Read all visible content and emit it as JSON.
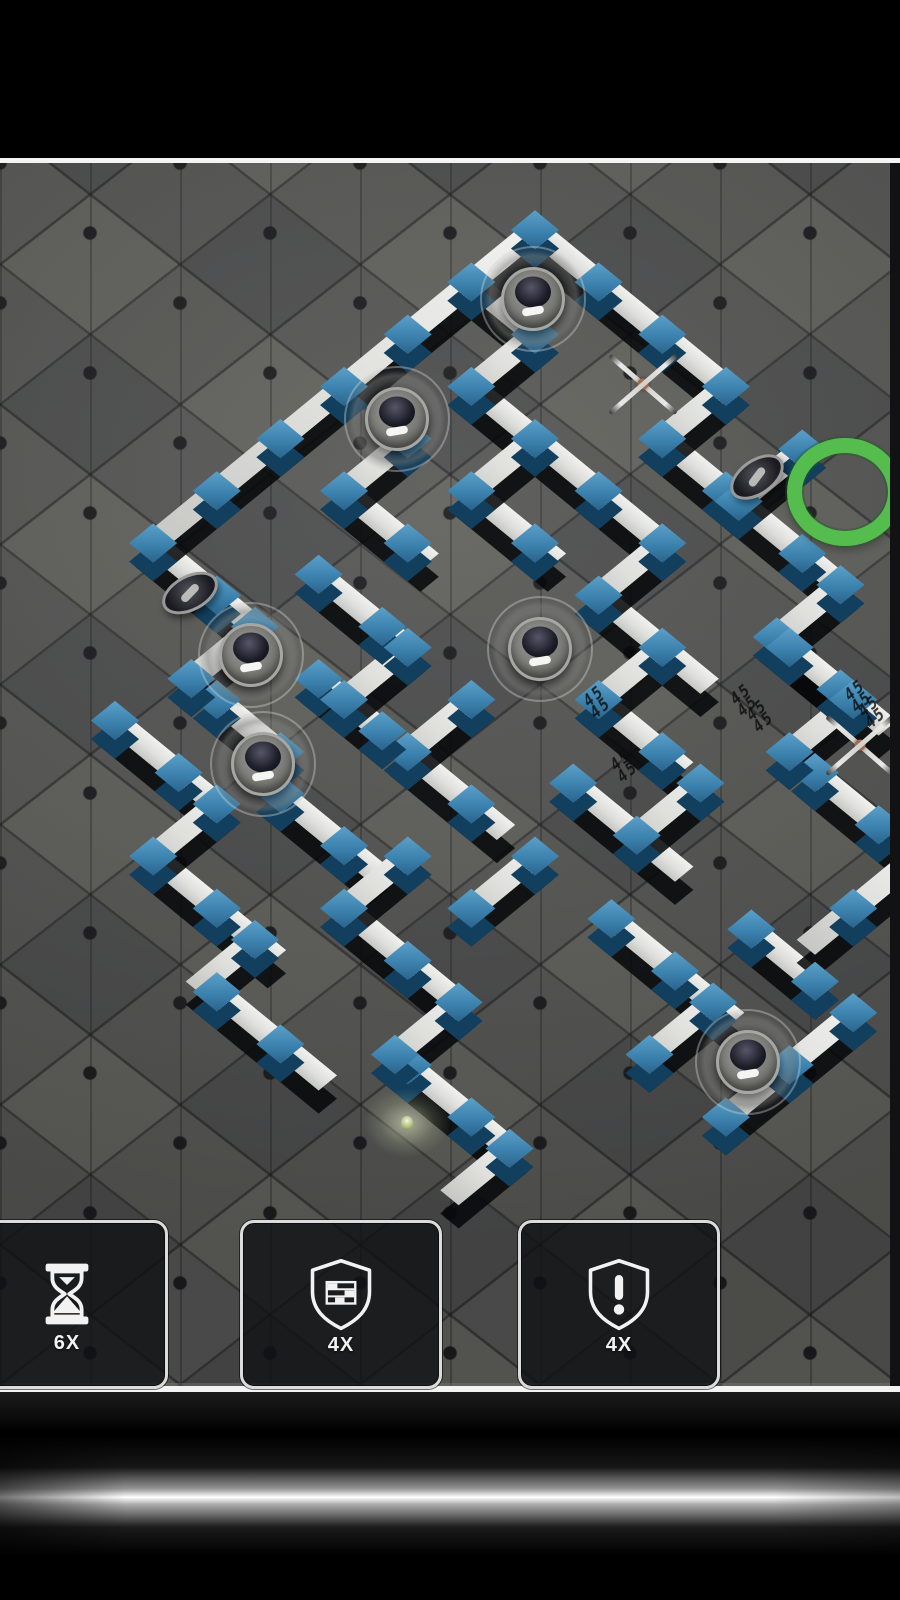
{
  "hud": {
    "boosters": [
      {
        "name": "time-booster",
        "icon": "hourglass-icon",
        "count": "6X"
      },
      {
        "name": "wall-booster",
        "icon": "shield-brick-icon",
        "count": "4X"
      },
      {
        "name": "alert-booster",
        "icon": "shield-alert-icon",
        "count": "4X"
      }
    ]
  },
  "colors": {
    "wall_top": "#e6e6e4",
    "wall_shadow": "#07080a",
    "connector_blue": "#3c82ae",
    "connector_blue_dark": "#123f5e",
    "floor": "#575754",
    "goal_green": "#55bd4e",
    "frame_white": "#f4f4f4",
    "button_border": "#dcdcdc"
  },
  "board": {
    "origin_x": 535,
    "origin_y": 230,
    "game_top": 163,
    "cell": 90,
    "rotation_deg": 45,
    "squash": 0.82,
    "segments": [
      {
        "d": "h",
        "x": 0,
        "y": 0,
        "l": 3
      },
      {
        "d": "h",
        "x": 3,
        "y": 1,
        "l": 1.2
      },
      {
        "d": "h",
        "x": 4.2,
        "y": 1,
        "l": 1.6
      },
      {
        "d": "h",
        "x": 5.8,
        "y": 2,
        "l": 1.2
      },
      {
        "d": "h",
        "x": 0,
        "y": 1,
        "l": 1,
        "t": 1
      },
      {
        "d": "h",
        "x": 1,
        "y": 2,
        "l": 2
      },
      {
        "d": "h",
        "x": 3,
        "y": 2,
        "l": 1
      },
      {
        "d": "h",
        "x": 2,
        "y": 3,
        "l": 1.2
      },
      {
        "d": "h",
        "x": 4,
        "y": 3,
        "l": 1.6
      },
      {
        "d": "h",
        "x": 6,
        "y": 2,
        "l": 1.4
      },
      {
        "d": "h",
        "x": 7.4,
        "y": 3,
        "l": 1.6
      },
      {
        "d": "h",
        "x": 5,
        "y": 4,
        "l": 1.2
      },
      {
        "d": "h",
        "x": 5.6,
        "y": 5,
        "l": 1.6
      },
      {
        "d": "h",
        "x": 8.4,
        "y": 5,
        "l": 1
      },
      {
        "d": "h",
        "x": 7.2,
        "y": 6,
        "l": 1.8
      },
      {
        "d": "h",
        "x": 4,
        "y": 6,
        "l": 1.4
      },
      {
        "d": "h",
        "x": 2.6,
        "y": 6,
        "l": 1,
        "t": 1
      },
      {
        "d": "h",
        "x": 0,
        "y": 6,
        "l": 1.6,
        "t": 1
      },
      {
        "d": "h",
        "x": 1.6,
        "y": 5,
        "l": 1.4
      },
      {
        "d": "h",
        "x": 1,
        "y": 4,
        "l": 1.2
      },
      {
        "d": "h",
        "x": 2,
        "y": 7,
        "l": 1,
        "t": 1
      },
      {
        "d": "h",
        "x": 3.4,
        "y": 7.4,
        "l": 1.4
      },
      {
        "d": "h",
        "x": 5,
        "y": 8,
        "l": 1.8
      },
      {
        "d": "h",
        "x": 7,
        "y": 9,
        "l": 1.6
      },
      {
        "d": "h",
        "x": 1.4,
        "y": 8,
        "l": 1.6,
        "t": 1
      },
      {
        "d": "h",
        "x": 3,
        "y": 9,
        "l": 1.8,
        "t": 1
      },
      {
        "d": "h",
        "x": 4.8,
        "y": 9.8,
        "l": 1.6,
        "t": 1
      },
      {
        "d": "v",
        "x": 3,
        "y": 0,
        "l": 1
      },
      {
        "d": "v",
        "x": 4.2,
        "y": 0,
        "l": 1
      },
      {
        "d": "v",
        "x": 5.8,
        "y": 1,
        "l": 1
      },
      {
        "d": "v",
        "x": 7,
        "y": 2,
        "l": 1
      },
      {
        "d": "v",
        "x": 9,
        "y": 3,
        "l": 1.6
      },
      {
        "d": "v",
        "x": 1,
        "y": 1,
        "l": 1
      },
      {
        "d": "v",
        "x": 0,
        "y": 0,
        "l": 6,
        "t": 1
      },
      {
        "d": "v",
        "x": 2,
        "y": 2,
        "l": 1
      },
      {
        "d": "v",
        "x": 4,
        "y": 2,
        "l": 1
      },
      {
        "d": "v",
        "x": 5,
        "y": 3,
        "l": 1
      },
      {
        "d": "v",
        "x": 6.6,
        "y": 4,
        "l": 1
      },
      {
        "d": "v",
        "x": 1,
        "y": 3,
        "l": 1
      },
      {
        "d": "v",
        "x": 3,
        "y": 5,
        "l": 1
      },
      {
        "d": "v",
        "x": 1.6,
        "y": 6,
        "l": 1,
        "t": 1
      },
      {
        "d": "v",
        "x": 5,
        "y": 7,
        "l": 1
      },
      {
        "d": "v",
        "x": 6.8,
        "y": 8,
        "l": 1
      },
      {
        "d": "v",
        "x": 8.6,
        "y": 9,
        "l": 0.8
      },
      {
        "d": "v",
        "x": 3,
        "y": 8,
        "l": 1,
        "t": 1
      },
      {
        "d": "v",
        "x": 4.6,
        "y": 9,
        "l": 0.8
      },
      {
        "d": "v",
        "x": 10,
        "y": 5,
        "l": 2
      },
      {
        "d": "v",
        "x": 8.8,
        "y": 6,
        "l": 1
      },
      {
        "d": "v",
        "x": 4,
        "y": 5,
        "l": 1
      },
      {
        "d": "v",
        "x": 6,
        "y": 6,
        "l": 1
      }
    ],
    "cameras": [
      [
        533,
        299
      ],
      [
        397,
        419
      ],
      [
        251,
        655
      ],
      [
        540,
        649
      ],
      [
        263,
        764
      ],
      [
        748,
        1062
      ]
    ],
    "small_cameras": [
      [
        757,
        477,
        -35
      ],
      [
        190,
        593,
        -28
      ]
    ],
    "drones": [
      [
        643,
        384
      ],
      [
        860,
        745
      ]
    ],
    "goal": {
      "x": 845,
      "y": 492
    },
    "player": {
      "x": 407,
      "y": 1123
    },
    "decals": {
      "text": "45\n45",
      "spots": [
        [
          597,
          702
        ],
        [
          624,
          766
        ],
        [
          744,
          700
        ],
        [
          760,
          716
        ],
        [
          858,
          696
        ],
        [
          872,
          712
        ]
      ]
    }
  }
}
